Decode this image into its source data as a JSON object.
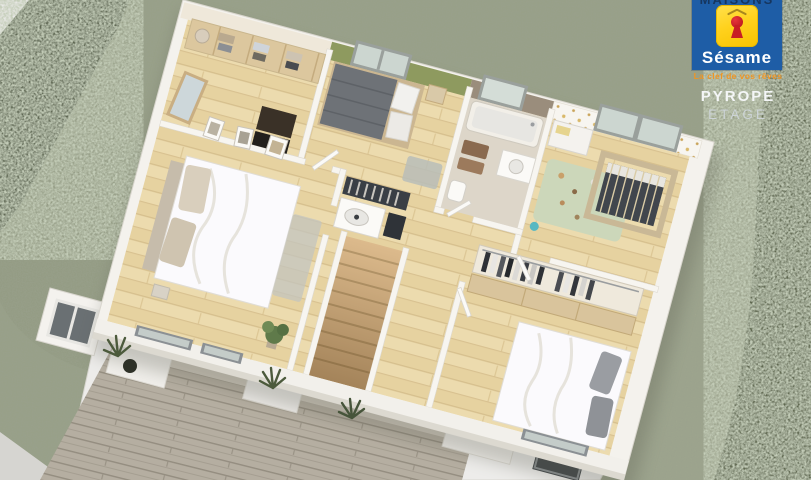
{
  "brand": {
    "top_text": "MAISONS",
    "name": "Sésame",
    "tagline": "La clef de vos rêves",
    "model": "PYROPE",
    "level": "ETAGE",
    "colors": {
      "panel_blue": "#1e5da6",
      "badge_yellow": "#ffd21e",
      "keyhole_red": "#c81e24",
      "tagline_orange": "#ef9523",
      "text_white": "#ffffff"
    }
  },
  "scene": {
    "type": "3d-floor-plan-render",
    "palette": {
      "grass": "#98a088",
      "hedge": "#5d6651",
      "wood_floor": "#ecdbae",
      "deck": "#b3ac9f",
      "wall_white": "#f4f2ed",
      "accent_wall_green": "#8e9a5f",
      "bathroom_wall_taupe": "#9a8d7c",
      "nursery_rug_green": "#ccd7ba"
    },
    "rooms": [
      {
        "name": "dressing"
      },
      {
        "name": "bedroom-green-wall"
      },
      {
        "name": "bathroom"
      },
      {
        "name": "nursery"
      },
      {
        "name": "master-bedroom"
      },
      {
        "name": "landing-staircase"
      },
      {
        "name": "bedroom-wardrobe"
      },
      {
        "name": "terrace-deck"
      },
      {
        "name": "garden-hedges"
      }
    ]
  }
}
